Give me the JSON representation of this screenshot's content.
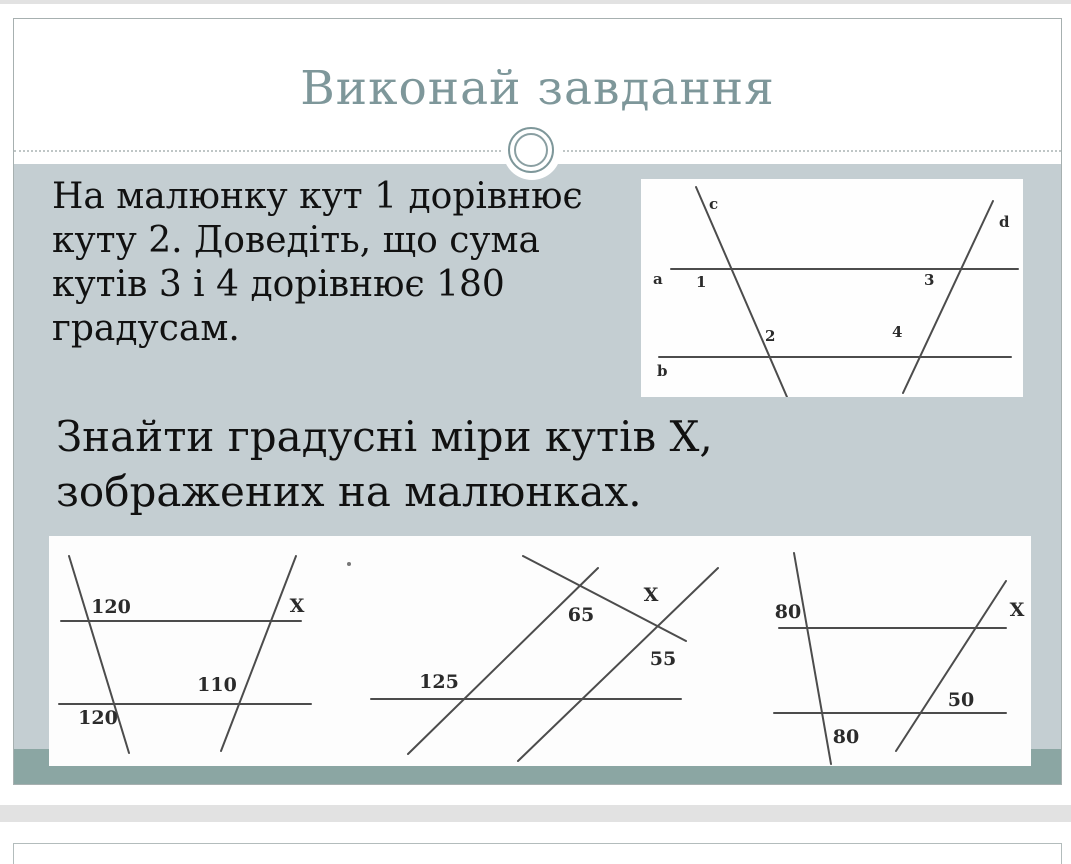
{
  "slide": {
    "title": "Виконай завдання",
    "task1": {
      "line1": "На малюнку кут 1 дорівнює",
      "line2": "куту 2. Доведіть, що сума",
      "line3": "кутів 3 і 4 дорівнює 180",
      "line4": "градусам."
    },
    "task2": {
      "line1": "Знайти градусні міри кутів X,",
      "line2": "зображених на малюнках."
    },
    "proof_diagram": {
      "line_a": "a",
      "line_b": "b",
      "line_c": "c",
      "line_d": "d",
      "angle_1": "1",
      "angle_2": "2",
      "angle_3": "3",
      "angle_4": "4"
    },
    "fig1": {
      "angle_top": "120",
      "x_label": "X",
      "angle_mid": "110",
      "angle_bottom": "120"
    },
    "fig2": {
      "angle_left": "125",
      "angle_upper": "65",
      "x_label": "X",
      "angle_lower": "55"
    },
    "fig3": {
      "angle_top_left": "80",
      "x_label": "X",
      "angle_right": "50",
      "angle_bottom": "80"
    },
    "colors": {
      "accent_title": "#7E979A",
      "teal_bar": "#8BA6A3",
      "content_background": "#C4CED2",
      "strip_gray": "#E2E2E2"
    }
  }
}
